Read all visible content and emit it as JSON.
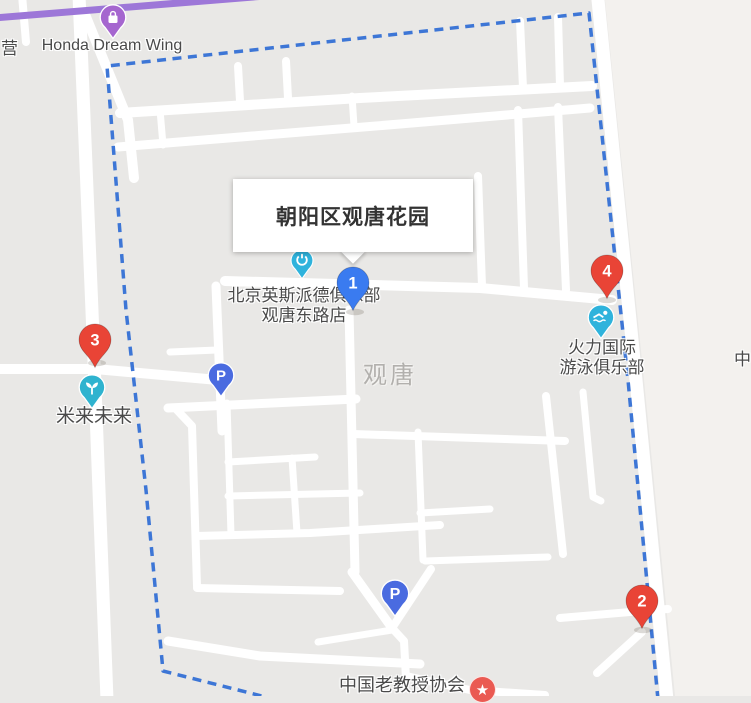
{
  "infobox": {
    "title": "朝阳区观唐花园"
  },
  "markers": [
    {
      "number": "1",
      "color": "#3a7bf0"
    },
    {
      "number": "2",
      "color": "#e94436"
    },
    {
      "number": "3",
      "color": "#e94436"
    },
    {
      "number": "4",
      "color": "#e94436"
    }
  ],
  "pois": {
    "honda": {
      "label": "Honda Dream Wing",
      "icon": "shopping-bag",
      "color": "#a566cf"
    },
    "club": {
      "label_line1": "北京英斯派德俱乐部",
      "label_line2": "观唐东路店",
      "icon": "fitness",
      "color": "#2fb3dc"
    },
    "milai": {
      "label": "米来未来",
      "icon": "sprout",
      "color": "#2fb3cf"
    },
    "swim": {
      "label_line1": "火力国际",
      "label_line2": "游泳俱乐部",
      "icon": "swimmer",
      "color": "#2fb3dc"
    },
    "professor": {
      "label": "中国老教授协会",
      "icon": "star",
      "color": "#ea5a52"
    },
    "parking": {
      "label": "P",
      "icon": "parking",
      "color": "#4a6be0"
    }
  },
  "map_texts": {
    "district": "观唐",
    "left_edge_cutoff": "营",
    "right_edge_cutoff": "中"
  },
  "colors": {
    "boundary_dash": "#3d76d6",
    "transit_line": "#9d77d8",
    "block_gray": "#e9e8e6",
    "outside_light": "#f3f1ee",
    "road_white": "#ffffff"
  }
}
